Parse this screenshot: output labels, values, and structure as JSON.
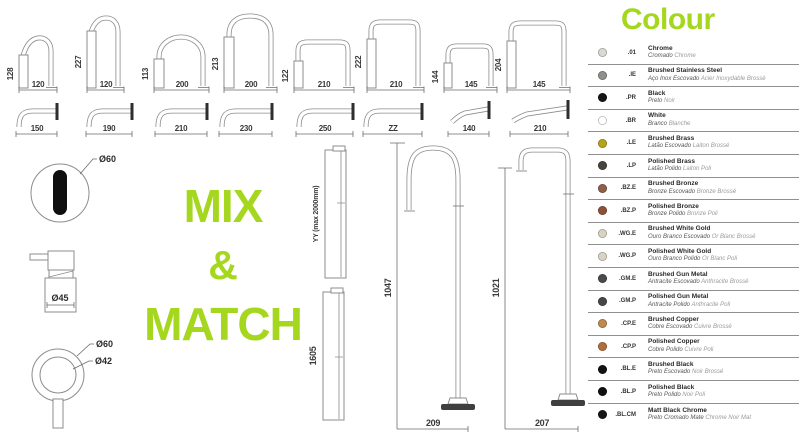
{
  "colors": {
    "accent_green": "#a5d71e"
  },
  "mix_match": {
    "line1": "MIX",
    "line2": "&",
    "line3": "MATCH"
  },
  "top_spouts": [
    {
      "h": "128",
      "w": "120"
    },
    {
      "h": "227",
      "w": "120"
    },
    {
      "h": "113",
      "w": "200"
    },
    {
      "h": "213",
      "w": "200"
    },
    {
      "h": "122",
      "w": "210"
    },
    {
      "h": "222",
      "w": "210"
    },
    {
      "h": "144",
      "w": "145"
    },
    {
      "h": "204",
      "w": "145"
    }
  ],
  "wall_spouts": [
    {
      "w": "150"
    },
    {
      "w": "190"
    },
    {
      "w": "210"
    },
    {
      "w": "230"
    },
    {
      "w": "250"
    },
    {
      "w": "ZZ"
    },
    {
      "w": "140"
    },
    {
      "w": "210"
    }
  ],
  "details": {
    "sensor_diameter": "Ø60",
    "dispenser_diameter": "Ø45",
    "handle_outer_diameter": "Ø60",
    "handle_inner_diameter": "Ø42"
  },
  "risers": [
    {
      "label": "YY (max 2000mm)"
    },
    {
      "label": "1605"
    }
  ],
  "floor_spouts": [
    {
      "h": "1047",
      "w": "209"
    },
    {
      "h": "1021",
      "w": "207"
    }
  ],
  "legend": {
    "title": "Colour",
    "items": [
      {
        "code": ".01",
        "name": "Chrome",
        "pt": "Cromado",
        "fr": "Chrome",
        "swatch": "#d8d8d4"
      },
      {
        "code": ".IE",
        "name": "Brushed Stainless Steel",
        "pt": "Aço Inox Escovado",
        "fr": "Acier Inoxydable Brossé",
        "swatch": "#8f8f8c"
      },
      {
        "code": ".PR",
        "name": "Black",
        "pt": "Preto",
        "fr": "Noir",
        "swatch": "#151515"
      },
      {
        "code": ".BR",
        "name": "White",
        "pt": "Branco",
        "fr": "Blanche",
        "swatch": "#ffffff"
      },
      {
        "code": ".LE",
        "name": "Brushed Brass",
        "pt": "Latão Escovado",
        "fr": "Laiton Brossé",
        "swatch": "#b3a418"
      },
      {
        "code": ".LP",
        "name": "Polished Brass",
        "pt": "Latão Polido",
        "fr": "Laiton Poli",
        "swatch": "#46443c"
      },
      {
        "code": ".BZ.E",
        "name": "Brushed Bronze",
        "pt": "Bronze Escovado",
        "fr": "Bronze Brossé",
        "swatch": "#8d6049"
      },
      {
        "code": ".BZ.P",
        "name": "Polished Bronze",
        "pt": "Bronze Polido",
        "fr": "Bronze Poli",
        "swatch": "#8e5138"
      },
      {
        "code": ".WG.E",
        "name": "Brushed White Gold",
        "pt": "Ouro Branco Escovado",
        "fr": "Or Blanc Brossé",
        "swatch": "#d7d2c2"
      },
      {
        "code": ".WG.P",
        "name": "Polished White Gold",
        "pt": "Ouro Branco Polido",
        "fr": "Or Blanc Poli",
        "swatch": "#d9d4c5"
      },
      {
        "code": ".GM.E",
        "name": "Brushed Gun Metal",
        "pt": "Antracite Escovado",
        "fr": "Anthracite Brossé",
        "swatch": "#4a4a4a"
      },
      {
        "code": ".GM.P",
        "name": "Polished Gun Metal",
        "pt": "Antracite Polido",
        "fr": "Anthracite Poli",
        "swatch": "#474747"
      },
      {
        "code": ".CP.E",
        "name": "Brushed Copper",
        "pt": "Cobre Escovado",
        "fr": "Cuivre Brossé",
        "swatch": "#c08a4f"
      },
      {
        "code": ".CP.P",
        "name": "Polished Copper",
        "pt": "Cobre Polido",
        "fr": "Cuivre Poli",
        "swatch": "#b06e3b"
      },
      {
        "code": ".BL.E",
        "name": "Brushed Black",
        "pt": "Preto Escovado",
        "fr": "Noir Brossé",
        "swatch": "#131313"
      },
      {
        "code": ".BL.P",
        "name": "Polished Black",
        "pt": "Preto Polido",
        "fr": "Noir Poli",
        "swatch": "#101010"
      },
      {
        "code": ".BL.CM",
        "name": "Matt Black Chrome",
        "pt": "Preto Cromado Mate",
        "fr": "Chrome Noir Mat",
        "swatch": "#161616"
      }
    ]
  }
}
